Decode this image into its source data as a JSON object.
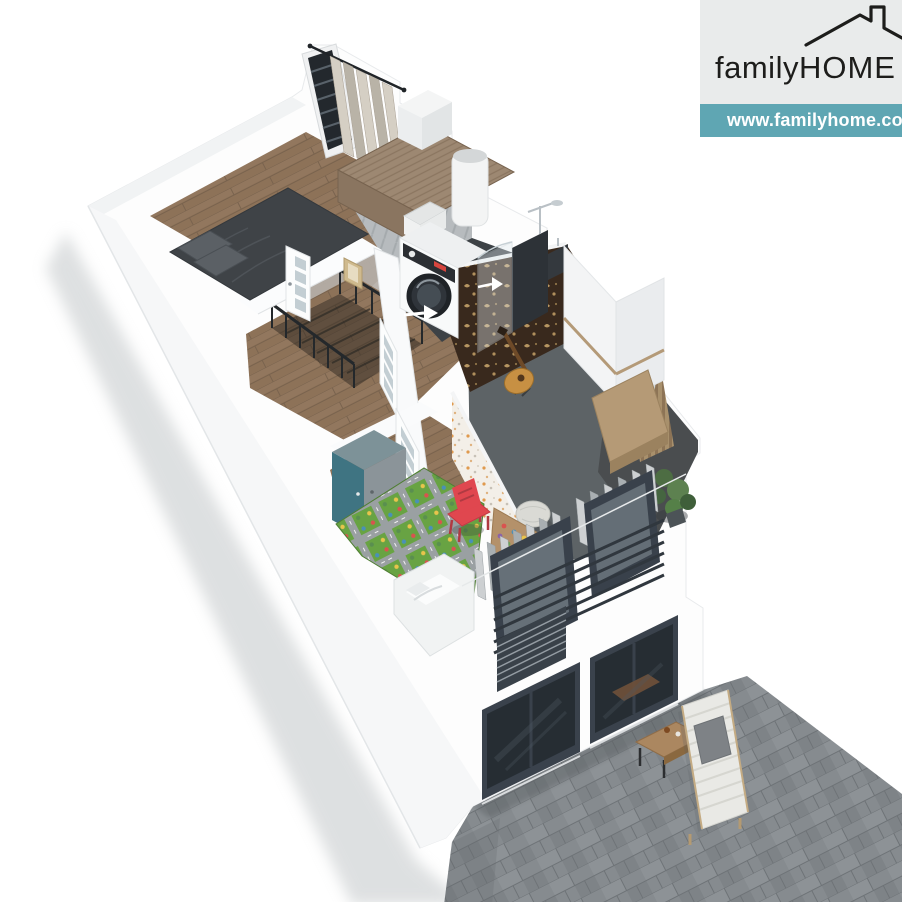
{
  "brand": {
    "logo": {
      "family": "family",
      "home": "HOME"
    },
    "website": "www.familyhome.com.",
    "colors": {
      "banner_teal": "#5fa6b3",
      "panel_gray": "#e9ebeb",
      "logo_ink": "#1d1d1b",
      "url_text": "#ffffff"
    }
  },
  "scene": {
    "description_colors_only": "3D cutaway floor plan render",
    "palette": {
      "wall_white": "#fdfdfd",
      "wood_floor": "#8d7258",
      "dark_tile": "#3d4246",
      "music_floor": "#5d6366",
      "paving_gray": "#868b8f",
      "railing_anthracite": "#39414b",
      "glass_dark": "#262d33",
      "mat_green": "#68a343",
      "chair_red": "#e0474f",
      "wardrobe_teal": "#3f7482",
      "wallpaper_brown": "#39291d",
      "wallpaper_gold": "#c5a26a",
      "bed_charcoal": "#3f4347",
      "curtain_beige": "#d5cfc4",
      "curtain_gray": "#cdd0d2",
      "bench_wood": "#b59a76",
      "plant_green": "#4e6e44"
    }
  }
}
